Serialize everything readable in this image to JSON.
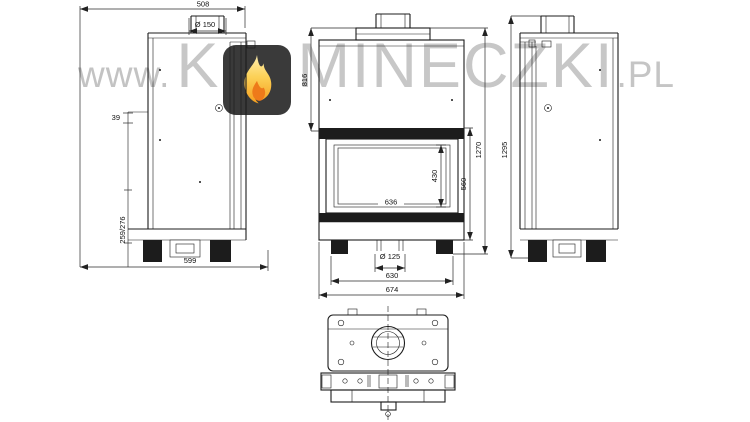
{
  "watermark": {
    "www": "www.",
    "brand_first_letter": "K",
    "brand_rest": "MINECZKI",
    "brand_suffix": ".PL"
  },
  "colors": {
    "badge_background": "#3a3a3a",
    "flame_yellow": "#fcd157",
    "flame_orange": "#ee7a1a",
    "watermark_gray": "#c7c7c7",
    "drawing_line": "#1c1c1c",
    "canvas": "#ffffff"
  },
  "drawing": {
    "side_view_left": {
      "depth_total": "508",
      "flue_diameter": "Ø 150",
      "flue_offset": "39",
      "rear_height": "259/276",
      "base_depth": "599"
    },
    "front_view": {
      "upper_section_height": "816",
      "glass_height": "430",
      "door_height": "560",
      "height_overall": "1270",
      "glass_width": "636",
      "air_inlet_diameter": "Ø 125",
      "base_width": "630",
      "width_overall": "674"
    },
    "side_view_right": {
      "height_overall": "1295"
    }
  }
}
